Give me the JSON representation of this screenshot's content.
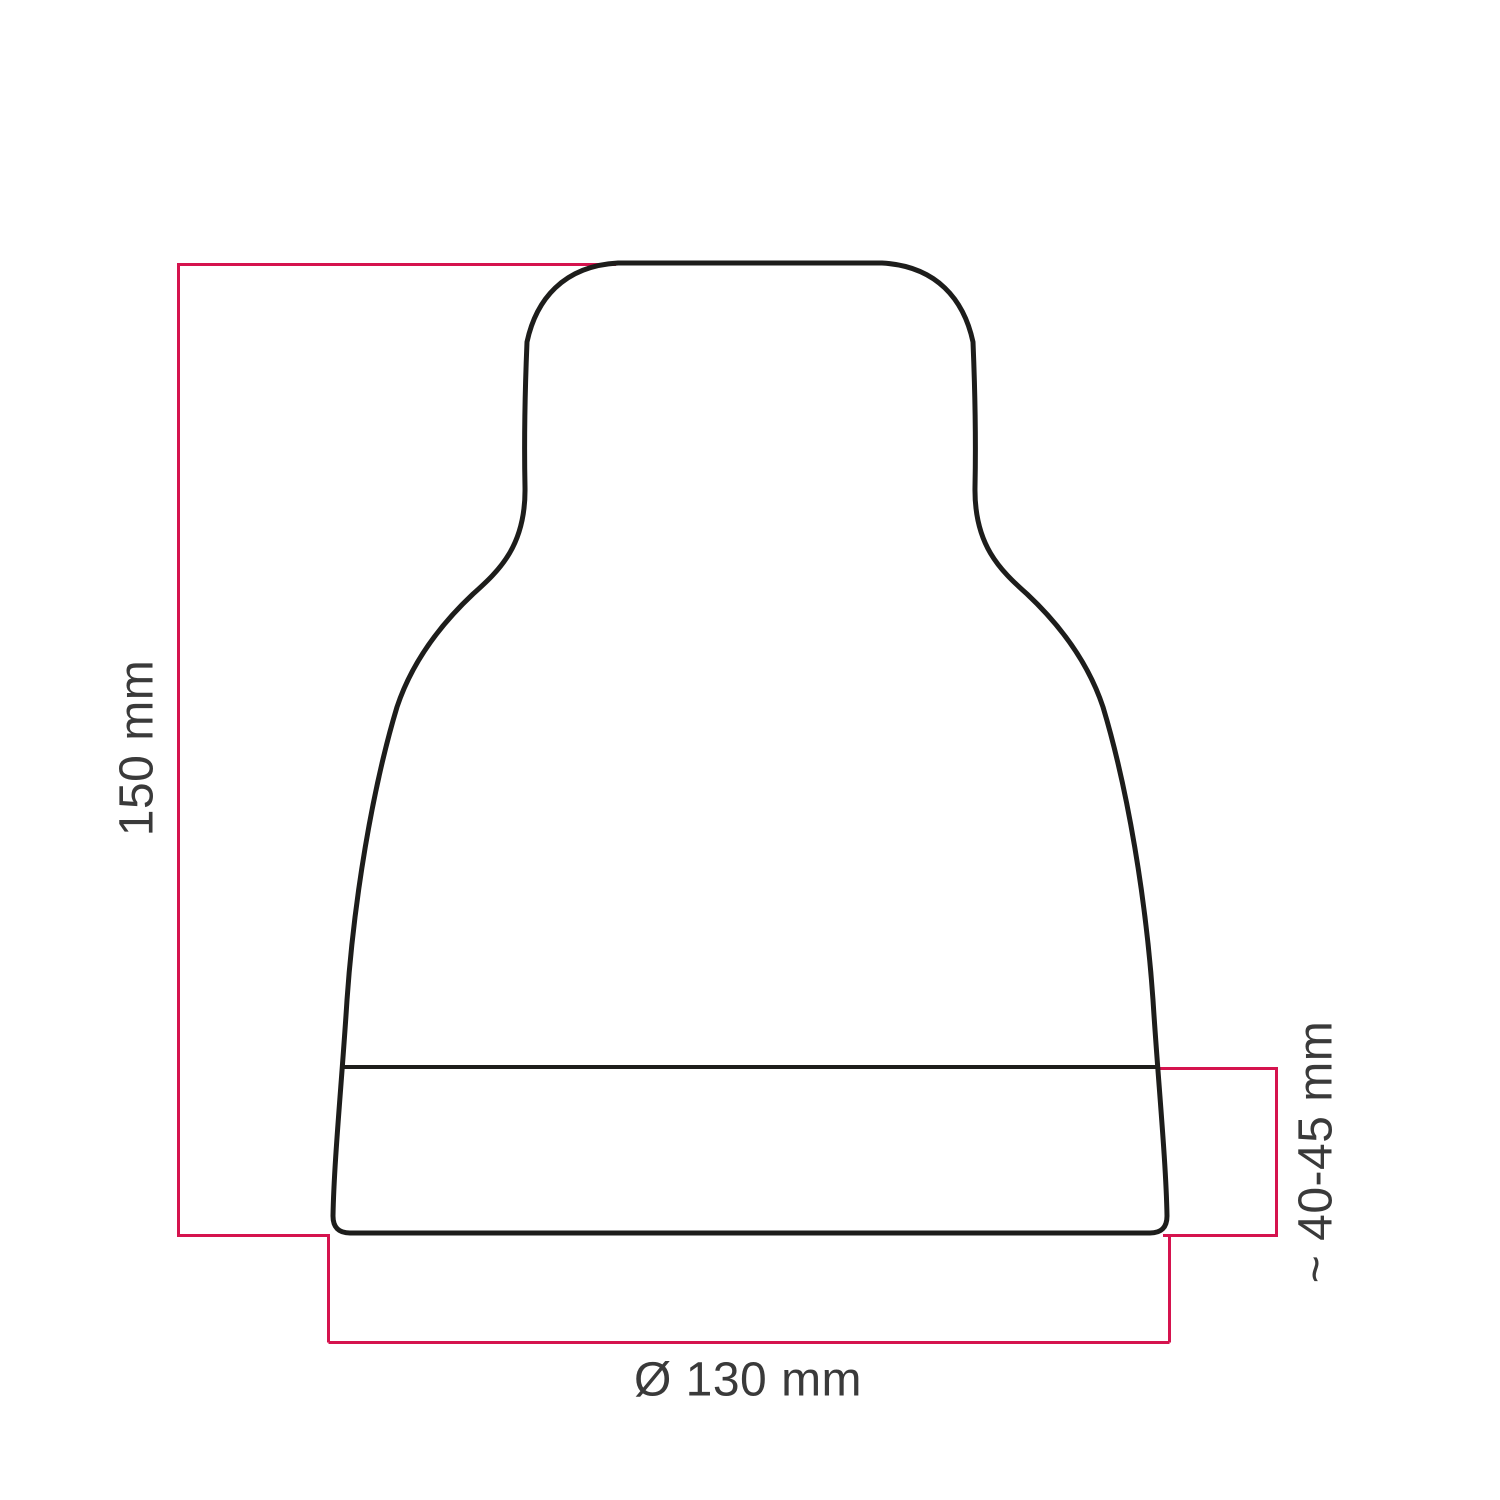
{
  "diagram": {
    "type": "technical-dimension-drawing",
    "subject": "bell-shaped lampshade cover, front profile with dimension lines",
    "labels": {
      "height": "150 mm",
      "band_height": "~ 40-45 mm",
      "diameter": "Ø 130 mm"
    },
    "dimensions": {
      "total_height_mm": 150,
      "bottom_band_height_mm": "40-45 (approx)",
      "base_diameter_mm": 130
    },
    "colors": {
      "dimension_line": "#d5134e",
      "outline": "#1d1d1b",
      "label_text": "#3a3a3a",
      "background": "#ffffff"
    }
  }
}
